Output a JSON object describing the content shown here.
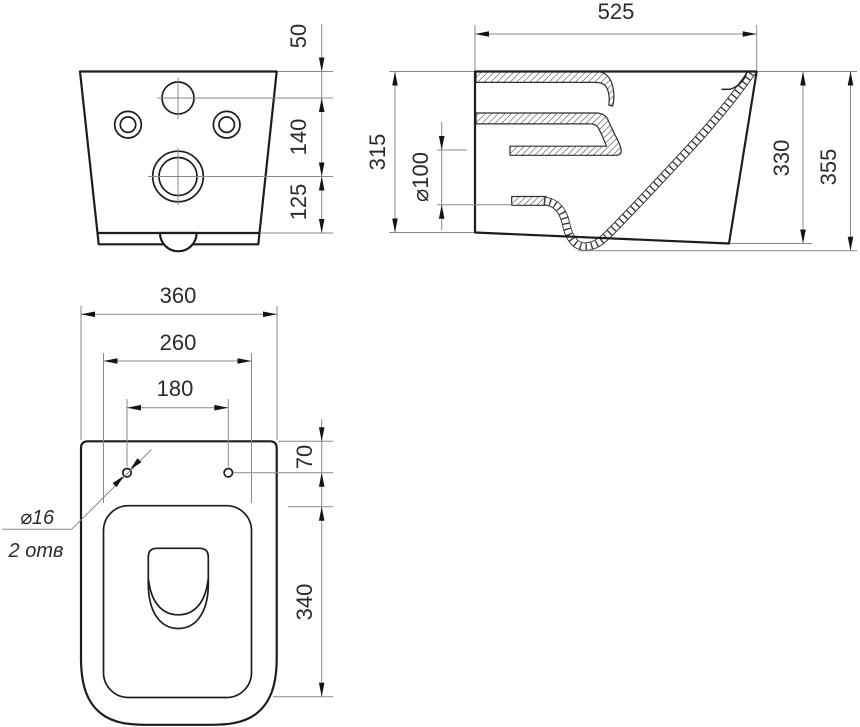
{
  "drawing": {
    "type": "technical-drawing",
    "background": "#ffffff",
    "line_color": "#1d1d1d",
    "thin_line_color": "#8a8a8a",
    "views": {
      "rear": {
        "label": "rear-view",
        "dims": {
          "d50": "50",
          "d140": "140",
          "d125": "125"
        }
      },
      "section": {
        "label": "side-section-view",
        "dims": {
          "d525": "525",
          "d315": "315",
          "d100": "⌀100",
          "d330": "330",
          "d355": "355"
        }
      },
      "top": {
        "label": "plan-view",
        "dims": {
          "d360": "360",
          "d260": "260",
          "d180": "180",
          "d70": "70",
          "d340": "340"
        },
        "callout": {
          "diameter": "⌀16",
          "holes": "2 отв"
        }
      }
    }
  }
}
